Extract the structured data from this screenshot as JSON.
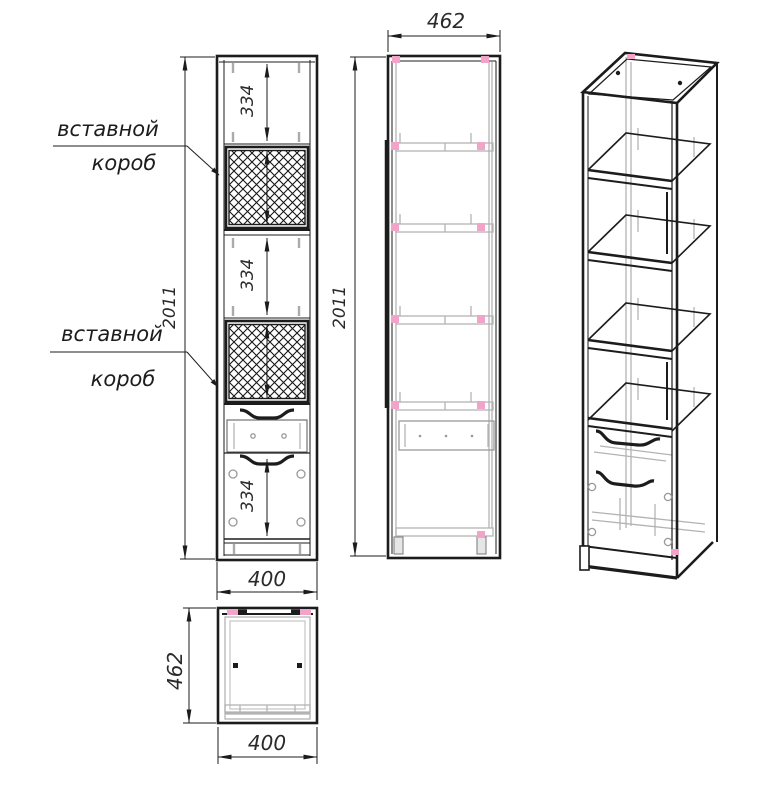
{
  "colors": {
    "line": "#1c1c1c",
    "detail_gray": "#b3b3b3",
    "marker_pink": "#f2a3c9",
    "background": "#ffffff"
  },
  "front_view": {
    "dim_height": "2011",
    "dim_width": "400",
    "dim_section_top": "334",
    "dim_section_middle": "334",
    "dim_section_door": "334",
    "callout_top": {
      "line1": "вставной",
      "line2": "короб"
    },
    "callout_bottom": {
      "line1": "вставной",
      "line2": "короб"
    }
  },
  "side_view": {
    "dim_depth": "462",
    "dim_height": "2011"
  },
  "top_view": {
    "dim_depth": "462",
    "dim_width": "400"
  }
}
